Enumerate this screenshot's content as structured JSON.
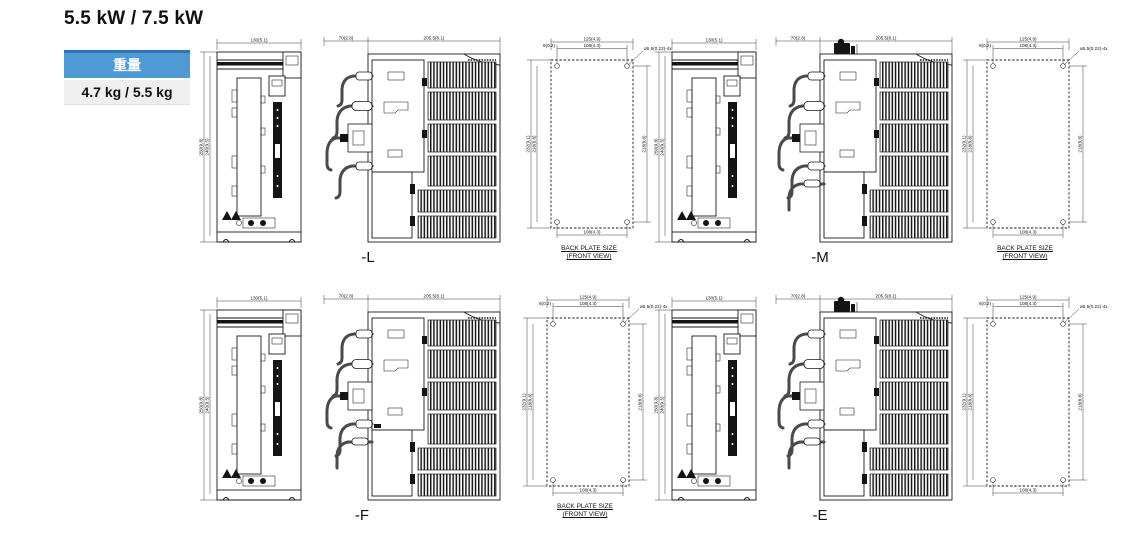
{
  "page": {
    "title": "5.5 kW / 7.5 kW"
  },
  "weight": {
    "header": "重量",
    "value": "4.7 kg / 5.5 kg"
  },
  "captions": {
    "back_plate_line1": "BACK PLATE SIZE",
    "back_plate_line2": "(FRONT VIEW)"
  },
  "groups": {
    "l": "-L",
    "m": "-M",
    "f": "-F",
    "e": "-E"
  },
  "dims": {
    "front_width": "130(5.1)",
    "front_height_outer": "250(9.8)",
    "front_height_inner": "240(9.5)",
    "side_front_depth": "70(2.8)",
    "side_body_depth": "205.5(8.1)",
    "bp_width_outer": "125(4.9)",
    "bp_width_inner": "108(4.3)",
    "bp_edge_offset": "6(0.2)",
    "bp_hole_callout": "ø5.5(0.22)-4x",
    "bp_height_outer": "232(9.1)",
    "bp_height_inner": "218(8.6)",
    "bp_height_right": "218(8.6)",
    "bp_width_bottom": "108(4.3)"
  }
}
